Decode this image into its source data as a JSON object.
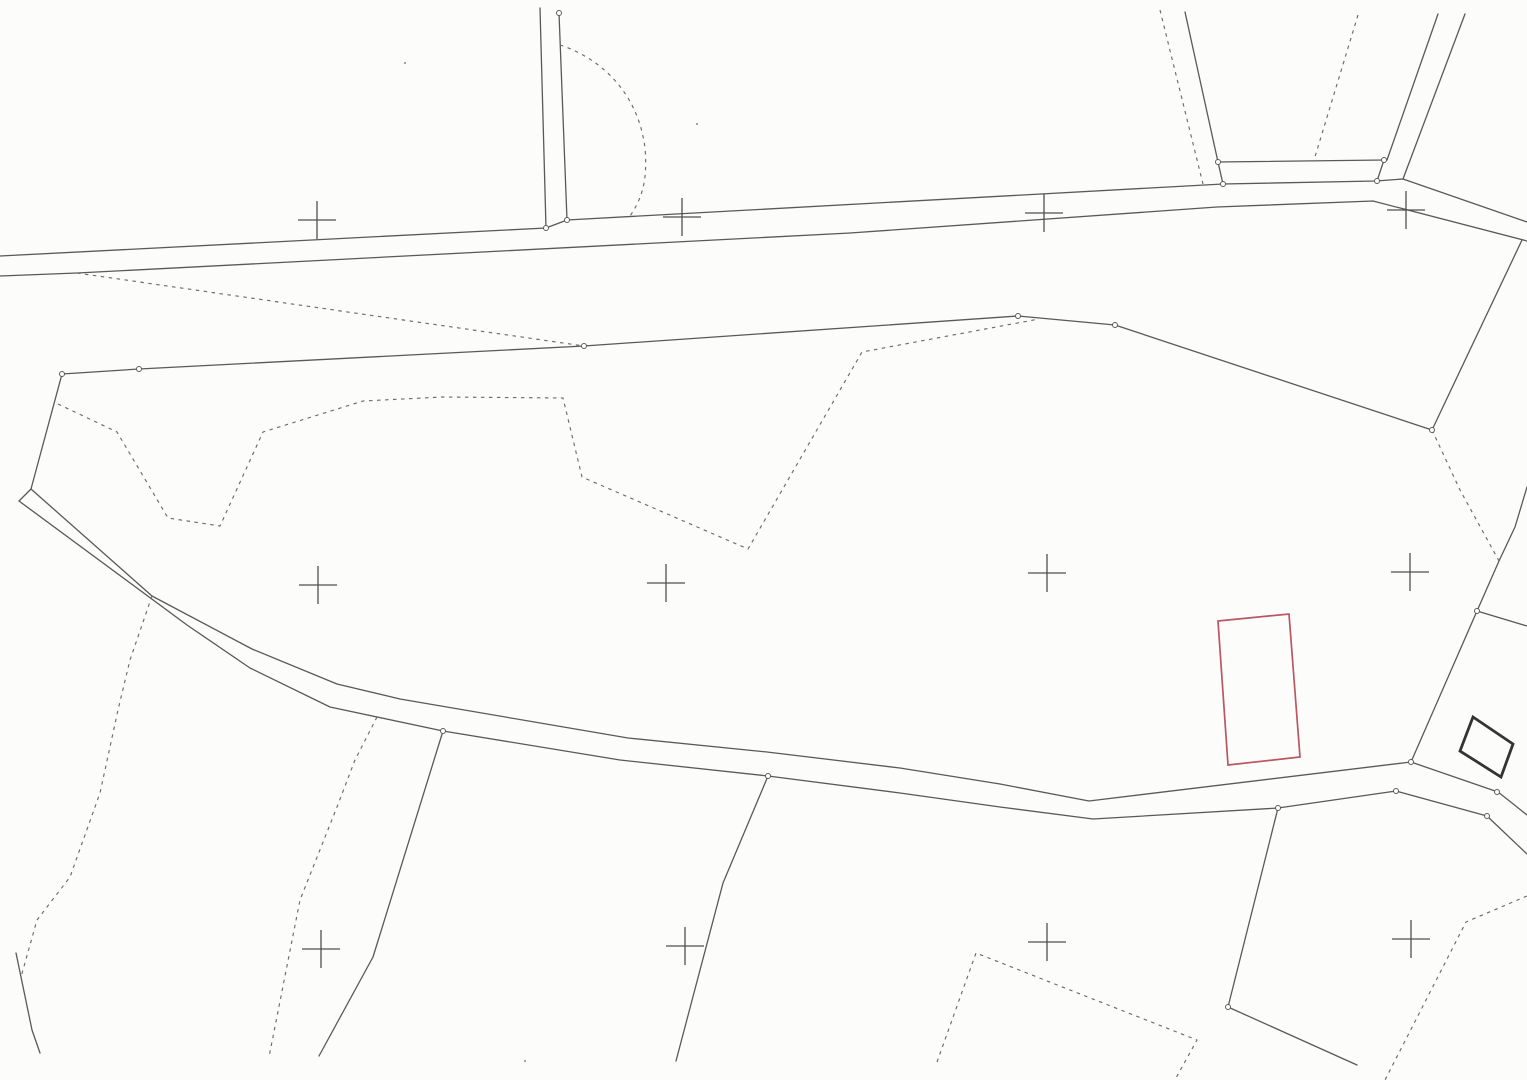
{
  "map": {
    "background": "#fcfcfb",
    "stroke": {
      "solid_color": "#595959",
      "dashed_color": "#6b6b6b",
      "cross_color": "#4f4f4f",
      "node_stroke": "#5a5a5a",
      "node_fill": "#ffffff",
      "red_color": "#bb5663",
      "bold_color": "#333333",
      "solid_width": 1.3,
      "dashed_width": 1.15,
      "dash_pattern": "3.5 4.5",
      "cross_width": 1.3,
      "cross_arm": 19,
      "node_radius": 2.5
    },
    "solid_lines": [
      {
        "name": "main-road-upper-edge",
        "points": [
          [
            0,
            256
          ],
          [
            546,
            228
          ],
          [
            567,
            220
          ],
          [
            1223,
            184
          ],
          [
            1376,
            181
          ],
          [
            1403,
            179
          ],
          [
            1527,
            222
          ]
        ]
      },
      {
        "name": "main-road-lower-edge",
        "points": [
          [
            0,
            276
          ],
          [
            77,
            273
          ],
          [
            850,
            233
          ],
          [
            1217,
            207
          ],
          [
            1373,
            201
          ],
          [
            1527,
            241
          ]
        ]
      },
      {
        "name": "lane-vertical-west",
        "points": [
          [
            540,
            8
          ],
          [
            546,
            228
          ]
        ]
      },
      {
        "name": "lane-vertical-east",
        "points": [
          [
            559,
            13
          ],
          [
            567,
            220
          ]
        ]
      },
      {
        "name": "plot-line-north-1",
        "points": [
          [
            1185,
            12
          ],
          [
            1218,
            162
          ]
        ]
      },
      {
        "name": "plot-connector-1",
        "points": [
          [
            1218,
            162
          ],
          [
            1223,
            184
          ]
        ]
      },
      {
        "name": "plot-top-line-north",
        "points": [
          [
            1218,
            162
          ],
          [
            1384,
            160
          ]
        ]
      },
      {
        "name": "plot-line-north-2",
        "points": [
          [
            1438,
            14
          ],
          [
            1387,
            160
          ]
        ]
      },
      {
        "name": "plot-connector-2",
        "points": [
          [
            1384,
            160
          ],
          [
            1377,
            181
          ]
        ]
      },
      {
        "name": "plot-line-north-3",
        "points": [
          [
            1465,
            14
          ],
          [
            1403,
            179
          ]
        ]
      },
      {
        "name": "parcel-boundary-main",
        "points": [
          [
            62,
            374
          ],
          [
            139,
            369
          ],
          [
            584,
            346
          ],
          [
            1018,
            316
          ],
          [
            1115,
            325
          ],
          [
            1432,
            430
          ]
        ]
      },
      {
        "name": "parcel-boundary-west-leg",
        "points": [
          [
            62,
            374
          ],
          [
            31,
            489
          ]
        ]
      },
      {
        "name": "track-end-cap",
        "points": [
          [
            31,
            489
          ],
          [
            19,
            501
          ]
        ]
      },
      {
        "name": "track-upper-edge",
        "points": [
          [
            31,
            489
          ],
          [
            152,
            596
          ],
          [
            252,
            649
          ],
          [
            337,
            684
          ],
          [
            400,
            699
          ],
          [
            628,
            738
          ],
          [
            767,
            752
          ],
          [
            900,
            768
          ],
          [
            1000,
            784
          ],
          [
            1089,
            801
          ],
          [
            1411,
            762
          ],
          [
            1498,
            792
          ],
          [
            1512,
            803
          ],
          [
            1527,
            815
          ]
        ]
      },
      {
        "name": "track-lower-edge",
        "points": [
          [
            19,
            501
          ],
          [
            187,
            625
          ],
          [
            250,
            668
          ],
          [
            330,
            707
          ],
          [
            443,
            731
          ],
          [
            620,
            760
          ],
          [
            768,
            776
          ],
          [
            900,
            793
          ],
          [
            1000,
            807
          ],
          [
            1093,
            819
          ],
          [
            1278,
            808
          ],
          [
            1396,
            791
          ],
          [
            1487,
            816
          ],
          [
            1527,
            854
          ]
        ]
      },
      {
        "name": "boundary-northeast",
        "points": [
          [
            1522,
            240
          ],
          [
            1432,
            430
          ]
        ]
      },
      {
        "name": "boundary-east",
        "points": [
          [
            1527,
            487
          ],
          [
            1515,
            527
          ],
          [
            1499,
            561
          ],
          [
            1477,
            611
          ],
          [
            1411,
            762
          ]
        ]
      },
      {
        "name": "boundary-east-branch",
        "points": [
          [
            1477,
            611
          ],
          [
            1527,
            626
          ]
        ]
      },
      {
        "name": "boundary-south-west",
        "points": [
          [
            443,
            731
          ],
          [
            373,
            957
          ],
          [
            319,
            1056
          ]
        ]
      },
      {
        "name": "boundary-south-middle",
        "points": [
          [
            768,
            776
          ],
          [
            723,
            883
          ],
          [
            676,
            1061
          ]
        ]
      },
      {
        "name": "boundary-southeast",
        "points": [
          [
            1278,
            808
          ],
          [
            1228,
            1007
          ],
          [
            1357,
            1065
          ]
        ]
      },
      {
        "name": "corner-mark-southwest",
        "points": [
          [
            16,
            953
          ],
          [
            21,
            977
          ],
          [
            32,
            1030
          ],
          [
            40,
            1053
          ]
        ]
      }
    ],
    "dashed_lines": [
      {
        "name": "ditch-dashed-north",
        "points": [
          [
            77,
            273
          ],
          [
            584,
            346
          ]
        ]
      },
      {
        "name": "plot-dashed-north-1",
        "points": [
          [
            1160,
            10
          ],
          [
            1203,
            184
          ]
        ]
      },
      {
        "name": "plot-dashed-north-2",
        "points": [
          [
            1358,
            15
          ],
          [
            1314,
            160
          ]
        ]
      },
      {
        "name": "field-contour-dashed",
        "points": [
          [
            58,
            404
          ],
          [
            117,
            432
          ],
          [
            168,
            518
          ],
          [
            220,
            526
          ],
          [
            263,
            432
          ],
          [
            363,
            401
          ],
          [
            443,
            397
          ],
          [
            563,
            398
          ],
          [
            582,
            477
          ],
          [
            748,
            549
          ],
          [
            862,
            352
          ],
          [
            1039,
            319
          ]
        ]
      },
      {
        "name": "boundary-east-dashed",
        "points": [
          [
            1432,
            430
          ],
          [
            1460,
            490
          ],
          [
            1499,
            561
          ]
        ]
      },
      {
        "name": "field-dashed-southwest",
        "points": [
          [
            152,
            596
          ],
          [
            130,
            660
          ],
          [
            118,
            710
          ],
          [
            100,
            793
          ],
          [
            70,
            877
          ],
          [
            37,
            920
          ],
          [
            21,
            977
          ]
        ]
      },
      {
        "name": "field-dashed-south",
        "points": [
          [
            377,
            717
          ],
          [
            355,
            760
          ],
          [
            337,
            807
          ],
          [
            300,
            900
          ],
          [
            269,
            1057
          ]
        ]
      },
      {
        "name": "field-dashed-southeast",
        "points": [
          [
            937,
            1062
          ],
          [
            976,
            953
          ],
          [
            1197,
            1040
          ],
          [
            1176,
            1078
          ]
        ]
      },
      {
        "name": "field-dashed-far-southeast",
        "points": [
          [
            1527,
            896
          ],
          [
            1466,
            922
          ],
          [
            1385,
            1080
          ]
        ]
      }
    ],
    "dashed_curves": [
      {
        "name": "field-arc-dashed",
        "d": "M 560 45 C 600 58, 638 92, 645 148 C 648 182, 641 200, 630 216"
      }
    ],
    "shapes": [
      {
        "name": "highlighted-parcel-outline",
        "points": [
          [
            1218,
            621
          ],
          [
            1289,
            614
          ],
          [
            1300,
            757
          ],
          [
            1228,
            765
          ]
        ],
        "stroke": "#bb5663",
        "width": 1.7
      },
      {
        "name": "building-footprint",
        "points": [
          [
            1473,
            717
          ],
          [
            1513,
            744
          ],
          [
            1501,
            777
          ],
          [
            1460,
            751
          ]
        ],
        "stroke": "#333333",
        "width": 2.8
      }
    ],
    "grid_crosses": [
      {
        "x": 317,
        "y": 220
      },
      {
        "x": 682,
        "y": 217
      },
      {
        "x": 1044,
        "y": 213
      },
      {
        "x": 1406,
        "y": 210
      },
      {
        "x": 318,
        "y": 585
      },
      {
        "x": 666,
        "y": 583
      },
      {
        "x": 1047,
        "y": 573
      },
      {
        "x": 1410,
        "y": 572
      },
      {
        "x": 321,
        "y": 949
      },
      {
        "x": 685,
        "y": 946
      },
      {
        "x": 1047,
        "y": 942
      },
      {
        "x": 1411,
        "y": 939
      }
    ],
    "node_circles": [
      [
        559,
        13
      ],
      [
        546,
        228
      ],
      [
        567,
        220
      ],
      [
        62,
        374
      ],
      [
        139,
        369
      ],
      [
        584,
        346
      ],
      [
        1018,
        316
      ],
      [
        1115,
        325
      ],
      [
        1218,
        162
      ],
      [
        1384,
        160
      ],
      [
        1223,
        184
      ],
      [
        1377,
        181
      ],
      [
        1432,
        430
      ],
      [
        1477,
        611
      ],
      [
        1411,
        762
      ],
      [
        1497,
        792
      ],
      [
        1396,
        791
      ],
      [
        1487,
        816
      ],
      [
        1278,
        808
      ],
      [
        1228,
        1007
      ],
      [
        443,
        731
      ],
      [
        768,
        776
      ]
    ],
    "specks": [
      [
        525,
        1061
      ],
      [
        697,
        124
      ],
      [
        405,
        63
      ]
    ]
  }
}
